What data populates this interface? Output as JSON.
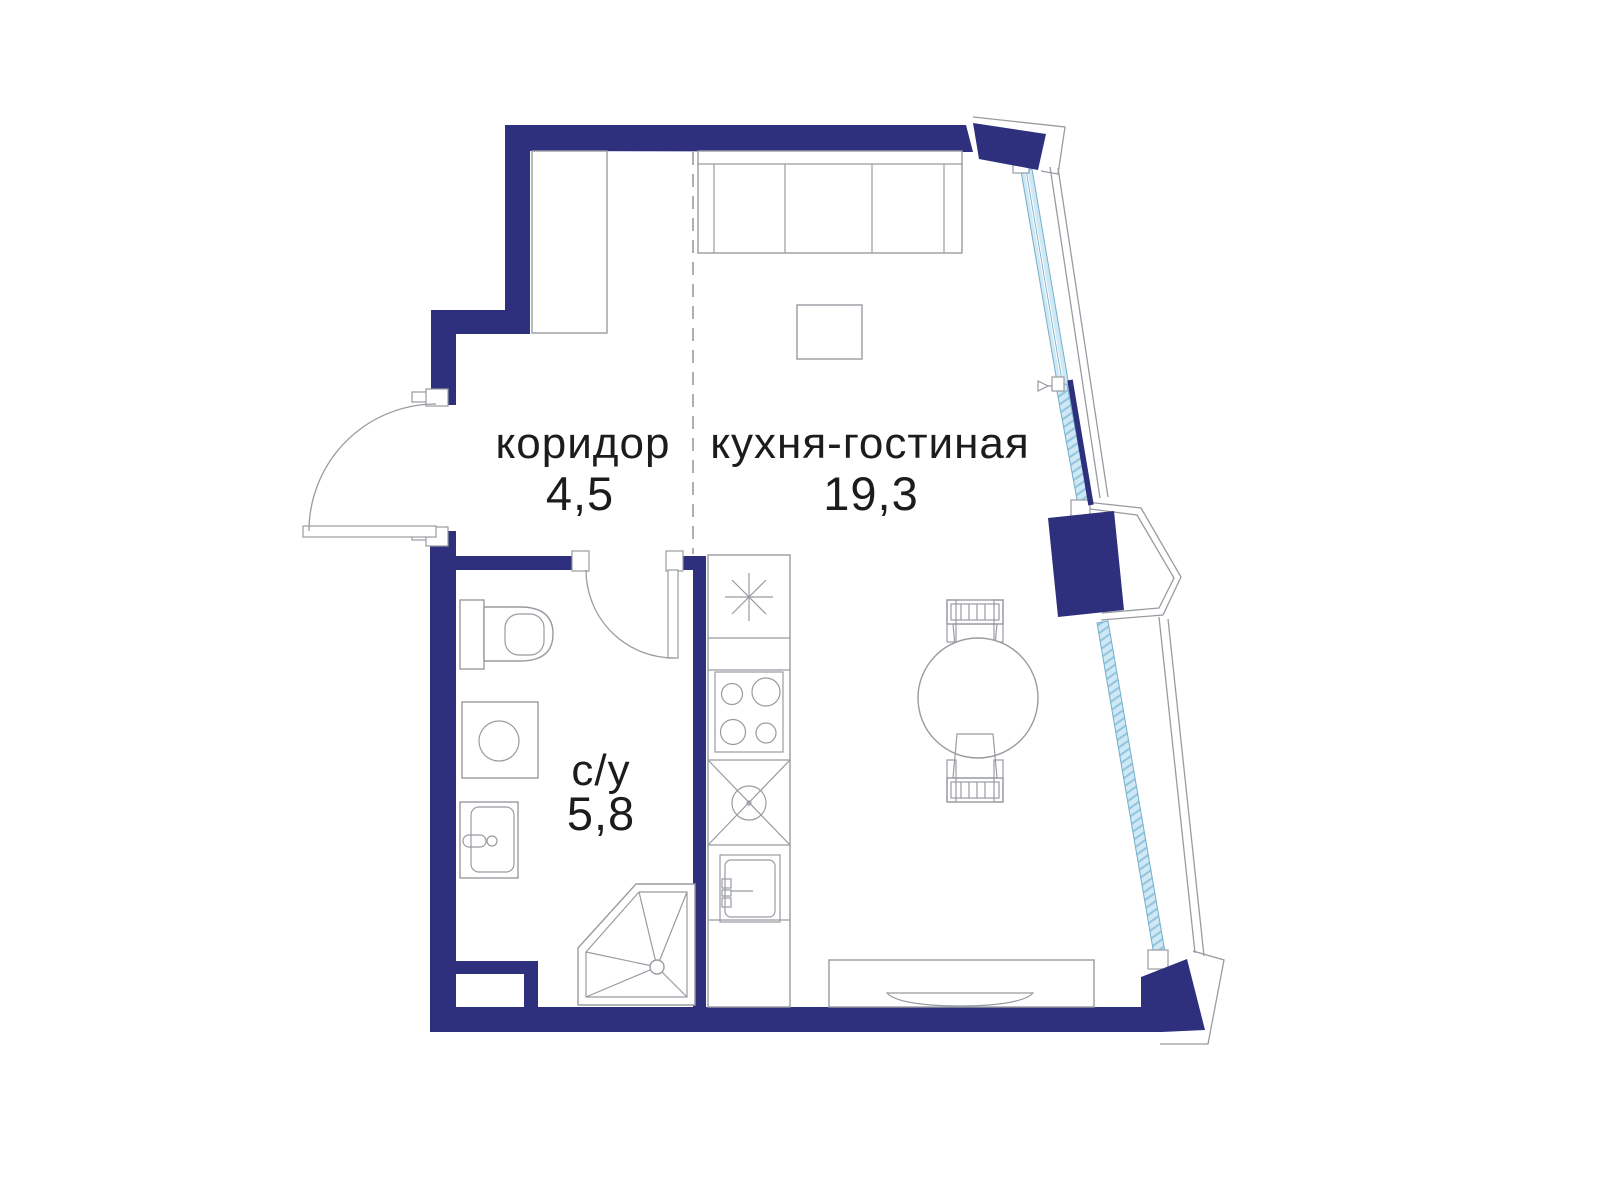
{
  "theme": {
    "bg_color": "#ffffff",
    "wall_color": "#2e2f7d",
    "glass_color": "#cfe8f5",
    "glass_stroke": "#76aecb",
    "glass_hatch": "#93c6de",
    "outline_color": "#989ba1",
    "dash_color": "#9a9aa1",
    "ink_color": "#1c1c1e"
  },
  "rooms": [
    {
      "id": "corridor",
      "name": "коридор",
      "area": "4,5"
    },
    {
      "id": "kitchen-living",
      "name": "кухня-гостиная",
      "area": "19,3"
    },
    {
      "id": "bathroom",
      "name": "с/у",
      "area": "5,8"
    }
  ],
  "fixtures": [
    "wardrobe",
    "sofa",
    "coffee-table",
    "dining-table",
    "dining-chair",
    "tv-console",
    "tv",
    "refrigerator",
    "hob",
    "kitchen-sink",
    "service-shaft",
    "toilet",
    "washing-machine",
    "washbasin",
    "shower",
    "entrance-door",
    "bathroom-door",
    "window",
    "bay-window",
    "balcony-rail"
  ]
}
